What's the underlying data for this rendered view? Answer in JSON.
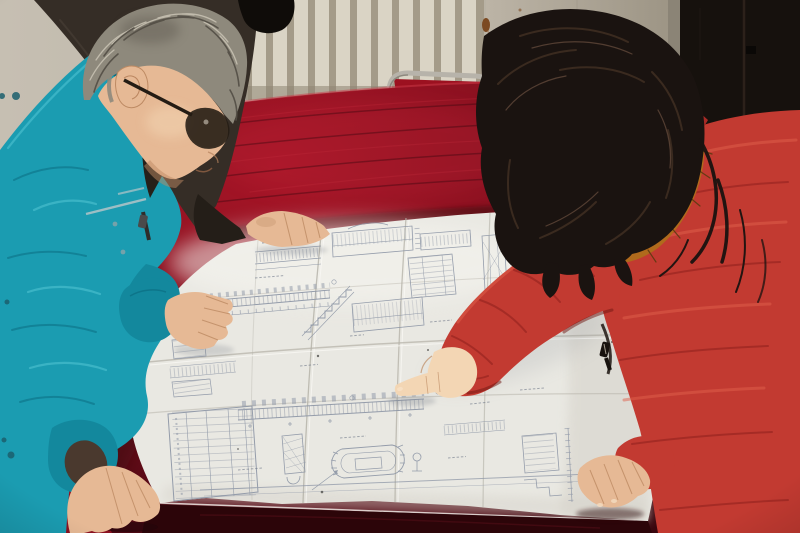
{
  "labels": {
    "scene": "Two engineers study a large folded construction blueprint spread on a crimson velvet covered table",
    "man": "Worker in teal jacket with glasses leaning over the drawing",
    "woman": "Woman in red padded coat with fur-trimmed hood pointing at the blueprint",
    "bystander": "Colleague in dark jacket standing behind the table",
    "blueprint": "Folded architectural blueprint with stair details, elevations and schedule tables",
    "table": "Table draped with dark red velvet cloth",
    "radiator": "White wall radiator",
    "door": "Dark door frame",
    "chair": "Metal framed chair with red upholstery",
    "wall": "Plain plaster wall with rust stains"
  },
  "colors": {
    "wall": "#c6bfb2",
    "wall_shade": "#b0a99b",
    "radiator": "#dad4c5",
    "radiator_gap": "#a49b89",
    "radiator_shadow": "#8e8573",
    "rust": "#7c4a22",
    "rust_light": "#95603a",
    "wall_right_a": "#bcb4a6",
    "wall_right_b": "#9b9383",
    "wall_corner": "#8b8476",
    "door": "#16110d",
    "door_seam": "#2c211a",
    "chair_metal": "#b7b3aa",
    "chair_metal_dark": "#6f6a60",
    "chair_seat": "#9c1120",
    "velvet_bright": "#a81527",
    "velvet_mid": "#8b1120",
    "velvet_dark": "#630c19",
    "velvet_deep": "#38070e",
    "velvet_front": "#2c0509",
    "velvet_sheen": "#c22c3c",
    "velvet_edge": "#c93b4a",
    "paper": "#e9e8e2",
    "paper_bright": "#f6f5f0",
    "paper_shade": "#d5d2c9",
    "crease": "#b3b0a6",
    "crease_hi": "#f9f8f4",
    "bp_line": "#8d96a6",
    "bp_dark": "#6e7787",
    "speck": "#3a3a38",
    "teal": "#1b9cb1",
    "teal_dark": "#13889d",
    "teal_deep": "#0b6e82",
    "teal_light": "#4fc3d2",
    "stripe": "#a3c0c5",
    "lining": "#4a392e",
    "jacket3": "#352d26",
    "jacket3_hi": "#4a4138",
    "jacket3_dark": "#241e18",
    "man_hair": "#8e897c",
    "man_hair_dark": "#534e45",
    "man_hair_light": "#c7c1b2",
    "skin": "#e6b995",
    "skin_dark": "#bd8a63",
    "skin_light": "#f3d6b4",
    "glasses": "#241c14",
    "woman_hair": "#1a1310",
    "woman_hair_hi": "#3e2d21",
    "woman_hair_hi2": "#61483a",
    "fur": "#b06a1c",
    "fur_hi": "#e4a73e",
    "fur_dark": "#5d3a10",
    "coat": "#c23a31",
    "coat_hi": "#e0604c",
    "coat_shadow": "#962420",
    "coat_deep": "#701512",
    "zip_dark": "#3a332e",
    "zip_metal": "#c8bfae",
    "shadow": "#7e838c"
  }
}
